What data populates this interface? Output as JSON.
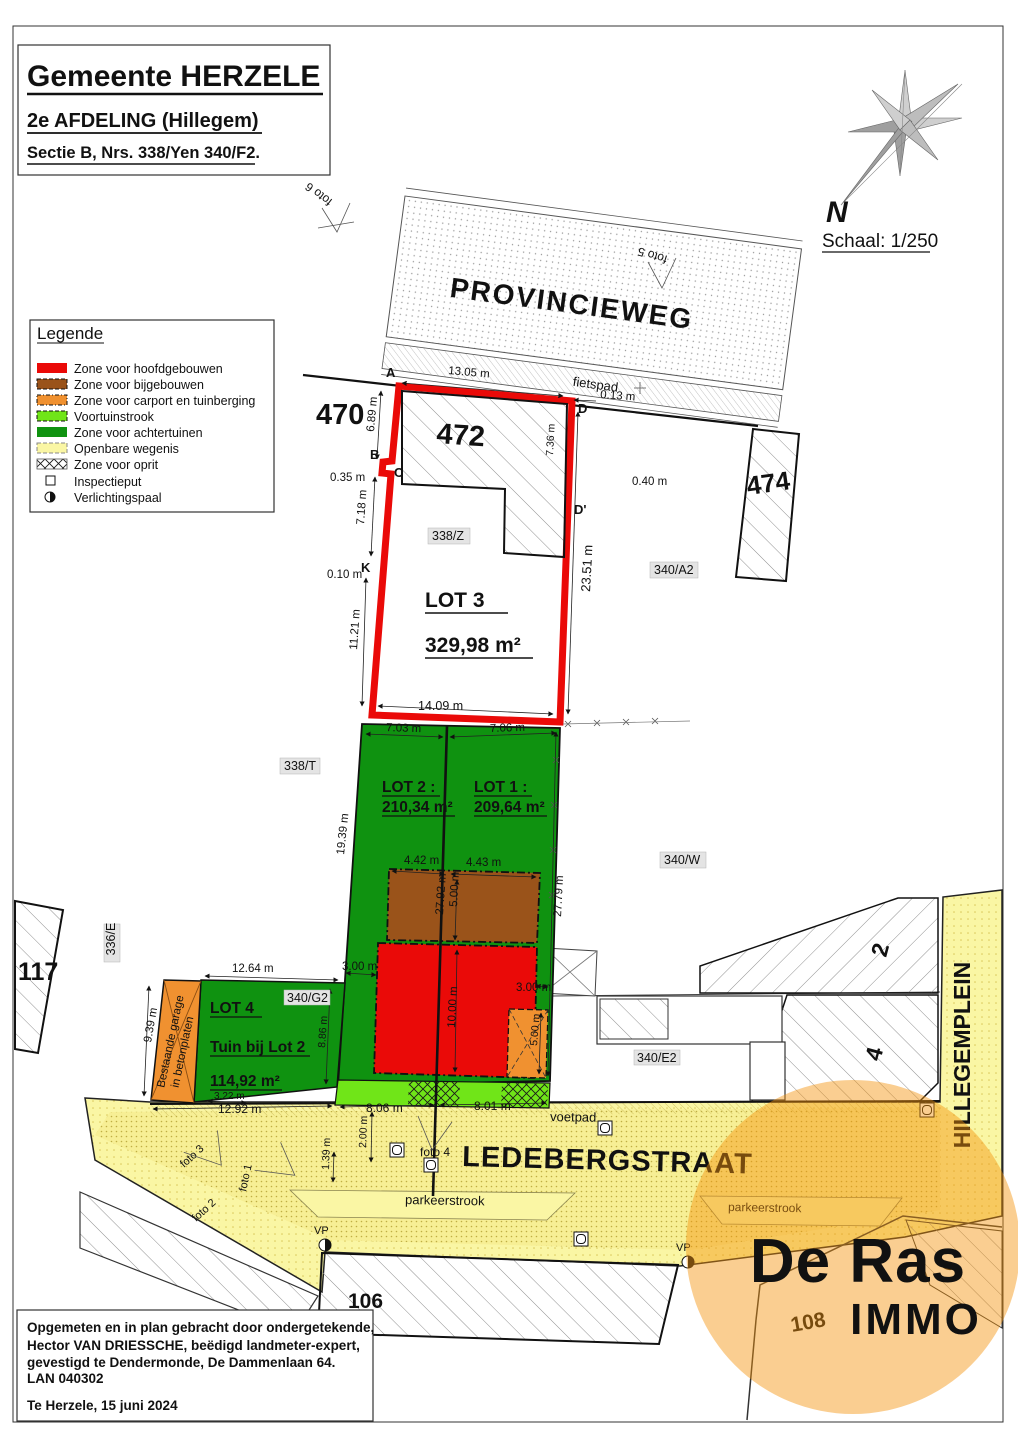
{
  "header": {
    "title": "Gemeente HERZELE",
    "subtitle": "2e AFDELING (Hillegem)",
    "section": "Sectie B, Nrs. 338/Yen 340/F2."
  },
  "compass": {
    "north": "N",
    "scale": "Schaal: 1/250"
  },
  "legend": {
    "title": "Legende",
    "items": [
      {
        "label": "Zone voor hoofdgebouwen",
        "color": "#ea0a08"
      },
      {
        "label": "Zone voor bijgebouwen",
        "color": "#9a531a"
      },
      {
        "label": "Zone voor carport en tuinberging",
        "color": "#f09130"
      },
      {
        "label": "Voortuinstrook",
        "color": "#70e518"
      },
      {
        "label": "Zone voor achtertuinen",
        "color": "#0f9210"
      },
      {
        "label": "Openbare wegenis",
        "color": "#faf6a4"
      },
      {
        "label": "Zone voor oprit",
        "color": "crosshatch"
      },
      {
        "label": "Inspectieput",
        "color": "symbol-square"
      },
      {
        "label": "Verlichtingspaal",
        "color": "symbol-halfcircle"
      }
    ]
  },
  "roads": {
    "provincieweg": "PROVINCIEWEG",
    "fietspad": "fietspad",
    "ledebergstraat": "LEDEBERGSTRAAT",
    "voetpad": "voetpad",
    "parkeerstrook1": "parkeerstrook",
    "parkeerstrook2": "parkeerstrook",
    "hillegemplein": "HILLEGEMPLEIN"
  },
  "parcels": {
    "n470": "470",
    "n472": "472",
    "n474": "474",
    "n117": "117",
    "n106": "106",
    "n108": "108",
    "n6": "6",
    "n2": "2",
    "n4": "4",
    "p338z": "338/Z",
    "p338t": "338/T",
    "p340a2": "340/A2",
    "p340w": "340/W",
    "p340g2": "340/G2",
    "p340e2": "340/E2",
    "p336e": "336/E"
  },
  "lots": {
    "lot3": {
      "name": "LOT 3",
      "area": "329,98 m²"
    },
    "lot2": {
      "name": "LOT 2 :",
      "area": "210,34 m²"
    },
    "lot1": {
      "name": "LOT 1 :",
      "area": "209,64 m²"
    },
    "lot4": {
      "name": "LOT 4",
      "sub": "Tuin bij Lot 2",
      "area": "114,92 m²"
    }
  },
  "points": {
    "a": "A",
    "b": "B",
    "c": "C",
    "d": "D",
    "dp": "D'",
    "k": "K"
  },
  "photos": {
    "f1": "foto 1",
    "f2": "foto 2",
    "f3": "foto 3",
    "f4": "foto 4",
    "f5": "foto 5",
    "f6": "foto 6"
  },
  "vp": "VP",
  "garage": {
    "line1": "Bestaande garage",
    "line2": "in betonplaten"
  },
  "dims": {
    "top_width": "13.05 m",
    "offset_d": "0.13 m",
    "left_a": "6.89 m",
    "notch": "0.35 m",
    "right_inner": "7.36 m",
    "offset_dp": "0.40 m",
    "left_b": "7.18 m",
    "offset_k": "0.10 m",
    "left_c": "11.21 m",
    "bottom_width": "14.09 m",
    "right_total": "23.51 m",
    "lot2_front": "7.03 m",
    "lot1_front": "7.06 m",
    "lot2_left": "19.39 m",
    "lot1_right": "27.79 m",
    "brown_l": "4.42 m",
    "brown_r": "4.43 m",
    "brown_depth": "5.00 m",
    "center_depth": "27.92 m",
    "side_l": "3.00 m",
    "side_r": "3.00 m",
    "red_depth": "10.00 m",
    "carport_depth": "5.00 m",
    "lot4_top": "12.64 m",
    "garage_left": "9.39 m",
    "lot4_right": "8.86 m",
    "lot4_bottom": "3.22 m",
    "street_a": "12.92 m",
    "street_b": "8.06 m",
    "street_c": "8.01 m",
    "voetpad_a": "2.00 m",
    "voetpad_b": "1.39 m"
  },
  "footer": {
    "line1": "Opgemeten en in plan gebracht door ondergetekende,",
    "line2": "Hector VAN DRIESSCHE, beëdigd landmeter-expert,",
    "line3": "gevestigd te Dendermonde, De Dammenlaan 64.",
    "line4": "LAN 040302",
    "line5": "Te Herzele, 15 juni 2024"
  },
  "watermark": {
    "name": "De Ras",
    "sub": "IMMO",
    "circle_color": "#f3920c",
    "sub_color": "#53504b"
  }
}
